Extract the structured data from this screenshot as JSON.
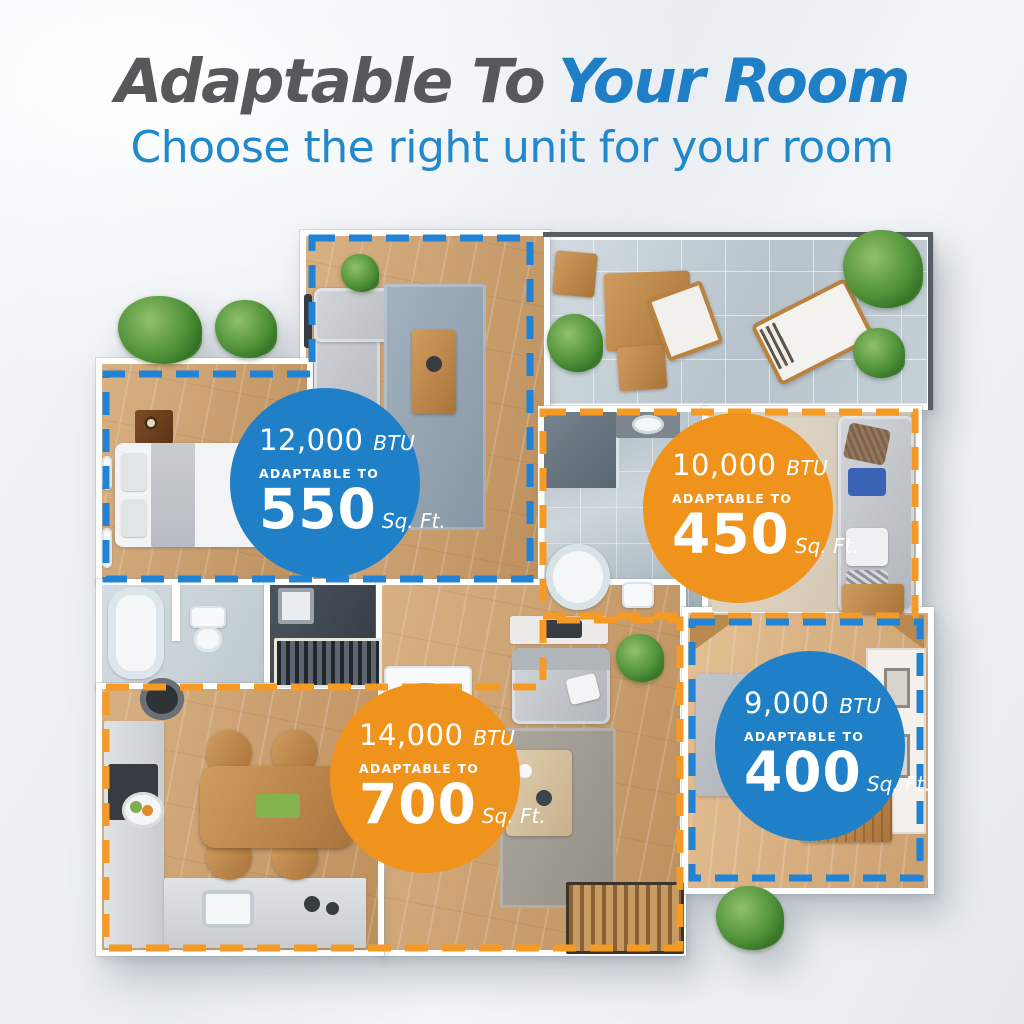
{
  "header": {
    "title_gray": "Adaptable To",
    "title_blue": "Your Room",
    "subtitle": "Choose the right unit for your room"
  },
  "colors": {
    "title_gray": "#57585a",
    "accent_blue": "#1f80c8",
    "accent_orange": "#f0931d",
    "dash_blue": "#2183d6",
    "dash_orange": "#f59a24"
  },
  "badges": [
    {
      "btu_value": "12,000",
      "btu_unit": "BTU",
      "adaptable_label": "ADAPTABLE TO",
      "area_value": "550",
      "area_unit": "Sq. Ft.",
      "style": "blue"
    },
    {
      "btu_value": "10,000",
      "btu_unit": "BTU",
      "adaptable_label": "ADAPTABLE TO",
      "area_value": "450",
      "area_unit": "Sq. Ft.",
      "style": "orange"
    },
    {
      "btu_value": "14,000",
      "btu_unit": "BTU",
      "adaptable_label": "ADAPTABLE TO",
      "area_value": "700",
      "area_unit": "Sq. Ft.",
      "style": "orange"
    },
    {
      "btu_value": "9,000",
      "btu_unit": "BTU",
      "adaptable_label": "ADAPTABLE TO",
      "area_value": "400",
      "area_unit": "Sq. Ft.",
      "style": "blue"
    }
  ]
}
